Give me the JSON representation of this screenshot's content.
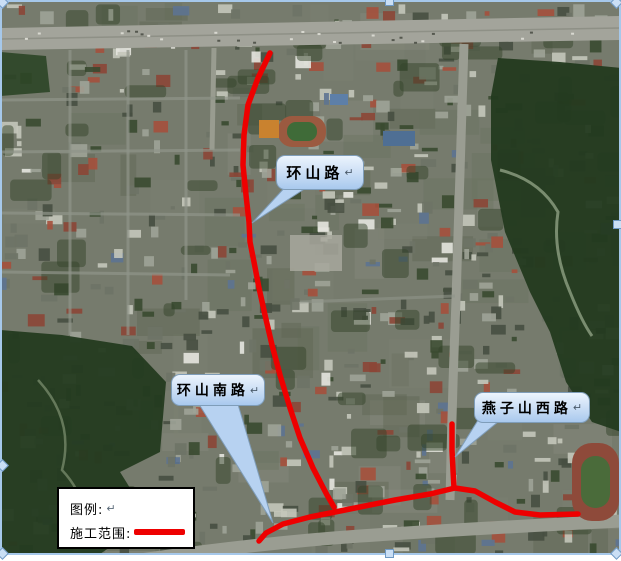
{
  "map": {
    "callouts": [
      {
        "label": "环山路",
        "mark": "↵"
      },
      {
        "label": "环山南路",
        "mark": "↵"
      },
      {
        "label": "燕子山西路",
        "mark": "↵"
      }
    ],
    "legend": {
      "title": "图例:",
      "title_mark": "↵",
      "item_label": "施工范围:",
      "swatch_color": "#ee0000"
    },
    "route_color": "#ee0000",
    "route_width": 5.5,
    "construction_routes": [
      {
        "name": "huanshan-road-segment",
        "points": [
          [
            270,
            53
          ],
          [
            258,
            78
          ],
          [
            248,
            105
          ],
          [
            244,
            135
          ],
          [
            243,
            165
          ],
          [
            246,
            195
          ],
          [
            249,
            222
          ],
          [
            250,
            242
          ],
          [
            254,
            262
          ],
          [
            259,
            288
          ],
          [
            265,
            315
          ],
          [
            272,
            345
          ],
          [
            280,
            375
          ],
          [
            290,
            408
          ],
          [
            300,
            438
          ],
          [
            313,
            468
          ],
          [
            327,
            495
          ],
          [
            334,
            507
          ]
        ]
      },
      {
        "name": "huanshan-south-east-segment",
        "points": [
          [
            259,
            541
          ],
          [
            266,
            533
          ],
          [
            283,
            524
          ],
          [
            310,
            517
          ],
          [
            345,
            510
          ],
          [
            395,
            500
          ],
          [
            430,
            494
          ],
          [
            455,
            488
          ],
          [
            475,
            491
          ],
          [
            495,
            502
          ],
          [
            515,
            512
          ],
          [
            540,
            515
          ],
          [
            578,
            514
          ]
        ]
      },
      {
        "name": "yanzishan-west-segment",
        "points": [
          [
            452,
            424
          ],
          [
            452,
            450
          ],
          [
            453,
            470
          ],
          [
            454,
            488
          ]
        ]
      }
    ],
    "selection_border_color": "#a6c8ea"
  }
}
